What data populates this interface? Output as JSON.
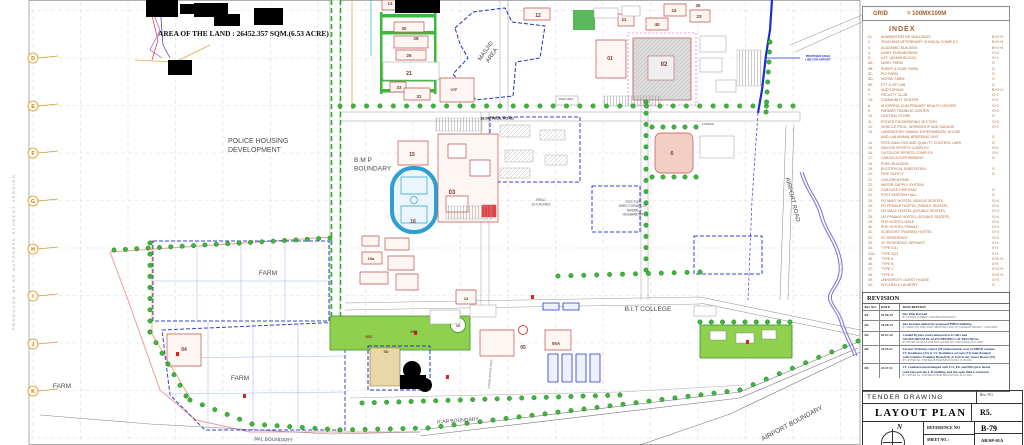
{
  "sheet": {
    "produced_by": "PRODUCED BY AN AUTODESK STUDENT VERSION",
    "area_note": "AREA OF THE LAND : 26452.357 SQM.(6.53 ACRE)"
  },
  "grid_panel": {
    "label": "GRID",
    "value": "= 100MX100M"
  },
  "index": {
    "title": "INDEX",
    "items": [
      {
        "no": "01.",
        "name": "ADMINISTRATIVE BUILDINGS",
        "fl": "B+G+3"
      },
      {
        "no": "2.",
        "name": "TEACHING VETERINARY CLINICAL COMPLEX",
        "fl": "B+G+3"
      },
      {
        "no": "3.",
        "name": "ACADEMIC BUILDING",
        "fl": "B+G+4"
      },
      {
        "no": "4.",
        "name": "DAIRY ENGINEERING",
        "fl": "G+3"
      },
      {
        "no": "5.",
        "name": "ILFC (ADMIN BLOCK)",
        "fl": "G+1"
      },
      {
        "no": "5A.",
        "name": "DAIRY FARM",
        "fl": "G"
      },
      {
        "no": "5B.",
        "name": "SHEEP & GOAT FARM",
        "fl": "G"
      },
      {
        "no": "5C.",
        "name": "PIG FARM",
        "fl": "G"
      },
      {
        "no": "5D.",
        "name": "HORSE FARM",
        "fl": "G"
      },
      {
        "no": "5E.",
        "name": "ETT & IVF LAB",
        "fl": "G"
      },
      {
        "no": "6.",
        "name": "AUDITORIUM",
        "fl": "B+G+1"
      },
      {
        "no": "7.",
        "name": "FACULTY CLUB",
        "fl": "G+1"
      },
      {
        "no": "7A.",
        "name": "COMMUNITY CENTER",
        "fl": "G+1"
      },
      {
        "no": "8.",
        "name": "SHOPPING CUM PRIMARY HEALTH CENTER",
        "fl": "G+1"
      },
      {
        "no": "9.",
        "name": "FARMER TRAINING CENTER",
        "fl": "G+2"
      },
      {
        "no": "10.",
        "name": "CENTRAL STORE",
        "fl": "G"
      },
      {
        "no": "11.",
        "name": "ESTATE ENGINEERING SECTION",
        "fl": "G+2"
      },
      {
        "no": "12.",
        "name": "VEHICLE POOL, WORKSHOP AND GARAGE",
        "fl": "G+1"
      },
      {
        "no": "13.",
        "name": "LABORATORY ANIMAL EXPERIMENTAL HOUSE",
        "fl": ""
      },
      {
        "no": "",
        "name": "AND LAB ANIMAL BREEDING UNIT",
        "fl": "G"
      },
      {
        "no": "14.",
        "name": "FEED ANALYSIS AND QUALITY CONTROL LABS",
        "fl": "G"
      },
      {
        "no": "15.",
        "name": "INDOOR SPORTS COMPLEX",
        "fl": "G+1"
      },
      {
        "no": "16.",
        "name": "OUTDOOR SPORTS COMPLEX",
        "fl": "G+1"
      },
      {
        "no": "17.",
        "name": "CAR/SCOOTER PARKING",
        "fl": "G"
      },
      {
        "no": "18.",
        "name": "PHED BUILDING",
        "fl": ""
      },
      {
        "no": "19.",
        "name": "ELECTRICAL SUBSTATION",
        "fl": "G"
      },
      {
        "no": "20.",
        "name": "FIRE SAFETY",
        "fl": "G"
      },
      {
        "no": "21.",
        "name": "CHILDREN PARK",
        "fl": ""
      },
      {
        "no": "22.",
        "name": "WATER SUPPLY SYSTEM",
        "fl": ""
      },
      {
        "no": "23.",
        "name": "CARCASS DISPOSAL",
        "fl": "G"
      },
      {
        "no": "24.",
        "name": "POST MORTEM HALL",
        "fl": "G"
      },
      {
        "no": "25.",
        "name": "PG MALE HOSTEL (SINGLE SEATER)",
        "fl": "G+4"
      },
      {
        "no": "26.",
        "name": "PG FEMALE HOSTEL (SINGLE SEATER)",
        "fl": "G+4"
      },
      {
        "no": "27.",
        "name": "UG MALE HOSTEL (DOUBLE SEATER)",
        "fl": "G+4"
      },
      {
        "no": "28.",
        "name": "UG FEMALE HOSTEL (DOUBLE SEATER)",
        "fl": "G+4"
      },
      {
        "no": "29.",
        "name": "PHD HOSTEL MALE",
        "fl": "G+4"
      },
      {
        "no": "30.",
        "name": "PHD HOSTEL FEMALE",
        "fl": "G+4"
      },
      {
        "no": "31.",
        "name": "SCIENTIST TRAINING HOSTEL",
        "fl": "G+4"
      },
      {
        "no": "32.",
        "name": "VC RESIDENCE",
        "fl": "G+2"
      },
      {
        "no": "33.",
        "name": "VC RESIDENCE SERVANT",
        "fl": "G+1"
      },
      {
        "no": "34.",
        "name": "TYPE S(1)",
        "fl": "S+4"
      },
      {
        "no": "34A.",
        "name": "TYPE S(2)",
        "fl": "S+4"
      },
      {
        "no": "35.",
        "name": "TYPE A",
        "fl": "S+G+4"
      },
      {
        "no": "36.",
        "name": "TYPE B",
        "fl": "S+4"
      },
      {
        "no": "37.",
        "name": "TYPE C",
        "fl": "S+G+4"
      },
      {
        "no": "38.",
        "name": "TYPE E",
        "fl": "S+G+4"
      },
      {
        "no": "39.",
        "name": "UNIVERSITY GUEST HOUSE",
        "fl": "G+4"
      },
      {
        "no": "40.",
        "name": "KITCHEN & LAUNDRY",
        "fl": "G"
      }
    ]
  },
  "revision": {
    "title": "REVISION",
    "headers": {
      "no": "Rev NO.",
      "date": "DATE",
      "desc": "DESCRIPTION"
    },
    "rows": [
      {
        "no": "R1.",
        "date": "01-08-19",
        "lines": [
          "Site Plan Revised"
        ],
        "note": "BY LETTER NUMBER -1148 REGISTRAR RAU"
      },
      {
        "no": "R2.",
        "date": "18-08-19",
        "lines": [
          "Site location added for proposed PHED building"
        ],
        "note": "BY MEMO NO. 1849 JOINT ARCHITECT BCD (P) SUNEESH RAPERT - 4 RAU/BCD"
      },
      {
        "no": "R3.",
        "date": "02-07-20",
        "lines": [
          "Candid Bypass road connected to ICAR road",
          "AUDITORIUM PLACED BEHIND L.B. BUILDING."
        ],
        "note": "BY NOTED ON 06-07-2020 AND LETTER NO. 2139 DATED 29-07-2020"
      },
      {
        "no": "R4.",
        "date": "24-05-21",
        "lines": [
          "Farmer Training Centre (09) Relocated in west of PHED campus",
          "VC Residence (32) & VC Residence servant (33) interchanged",
          "with Scientist Training Hostel(31) & University Guest House (39)"
        ],
        "note": "BY LETTER No. 1766 REGISTRAR BASU DATED 17-05-2021"
      },
      {
        "no": "R5.",
        "date": "23-07-21",
        "lines": [
          "VC residence interchanged with UG, PG and PhD girls hostel",
          "road between the L.B building and the open field is removed"
        ],
        "note": "BY LETTER No. 1766 REGISTRAR BASU DATED 19-07-2021"
      }
    ]
  },
  "titleblock": {
    "tender": "TENDER DRAWING",
    "rev_label": "Rev. NO.",
    "title": "LAYOUT PLAN",
    "rev": "R5.",
    "north": "N",
    "reference_label": "REFERENCE NO",
    "reference": "B-79",
    "sheet_label": "SHEET NO. :",
    "sheet": "AR/SP-01A"
  },
  "map": {
    "row_labels": [
      "D",
      "E",
      "F",
      "G",
      "H",
      "I",
      "J",
      "K"
    ],
    "labels": [
      {
        "lines": [
          "AREA OF THE LAND : 26452.357 SQM.(6.53 ACRE)"
        ],
        "x": 158,
        "y": 36,
        "s": 7.4,
        "cls": "serifb",
        "a": "s"
      },
      {
        "lines": [
          "POLICE HOUSING",
          "DEVELOPMENT"
        ],
        "x": 228,
        "y": 143,
        "s": 7,
        "a": "s",
        "cls": "grey"
      },
      {
        "lines": [
          "B.M P",
          "BOUNDARY"
        ],
        "x": 354,
        "y": 162,
        "s": 6.6,
        "a": "s",
        "cls": "grey"
      },
      {
        "lines": [
          "FARM"
        ],
        "x": 268,
        "y": 275,
        "s": 6.6,
        "a": "m",
        "cls": "grey"
      },
      {
        "lines": [
          "FARM"
        ],
        "x": 240,
        "y": 380,
        "s": 6.6,
        "a": "m",
        "cls": "grey"
      },
      {
        "lines": [
          "FARM"
        ],
        "x": 62,
        "y": 388,
        "s": 6.6,
        "a": "m",
        "cls": "grey"
      },
      {
        "lines": [
          "B.I.T COLLEGE"
        ],
        "x": 648,
        "y": 311,
        "s": 6.6,
        "a": "m",
        "cls": "grey"
      },
      {
        "lines": [
          "FIELD",
          "10.0 ACRES"
        ],
        "x": 541,
        "y": 201,
        "s": 3.4,
        "a": "m",
        "cls": "grey"
      },
      {
        "lines": [
          "SITE FOR",
          "DIRECTORATE OF",
          "ANIMAL",
          "HUSBANDRY"
        ],
        "x": 633,
        "y": 203,
        "s": 3.3,
        "a": "m",
        "cls": "grey"
      },
      {
        "lines": [
          "18.0M WIDE ROAD"
        ],
        "x": 497,
        "y": 119.5,
        "s": 3.8,
        "a": "m",
        "cls": "dark"
      },
      {
        "lines": [
          "MASJID",
          "AREA"
        ],
        "x": 487,
        "y": 52,
        "s": 6,
        "rot": -55,
        "a": "m",
        "cls": "grey"
      },
      {
        "lines": [
          "AIRPORT ROAD"
        ],
        "x": 791,
        "y": 200,
        "s": 6,
        "rot": 76,
        "a": "m",
        "cls": "grey"
      },
      {
        "lines": [
          "AIRPORT BOUNDARY"
        ],
        "x": 793,
        "y": 425,
        "s": 6.6,
        "rot": -28,
        "a": "m",
        "cls": "grey"
      },
      {
        "lines": [
          "ICAR BOUNDARY"
        ],
        "x": 458,
        "y": 422,
        "s": 5,
        "rot": -4,
        "a": "m",
        "cls": "grey"
      },
      {
        "lines": [
          "JAIL BOUNDARY"
        ],
        "x": 273,
        "y": 441,
        "s": 5,
        "rot": 2,
        "a": "m",
        "cls": "grey"
      },
      {
        "lines": [
          "PROPOSED 33KVA",
          "LINE FOR AIRPORT"
        ],
        "x": 818,
        "y": 57,
        "s": 2.7,
        "a": "m",
        "cls": "blue"
      },
      {
        "lines": [
          "COMFED"
        ],
        "x": 708,
        "y": 125,
        "s": 2.8,
        "a": "m",
        "cls": "grey"
      },
      {
        "lines": [
          "PARK AREA"
        ],
        "x": 566,
        "y": 100,
        "s": 2.6,
        "a": "m",
        "cls": "grey"
      },
      {
        "lines": [
          "CANDID BYPASS ROAD"
        ],
        "x": 491,
        "y": 374,
        "s": 2.6,
        "rot": -85,
        "a": "m",
        "cls": "grey"
      }
    ],
    "building_numbers": [
      {
        "t": "01",
        "x": 610,
        "y": 60,
        "s": 5
      },
      {
        "t": "02",
        "x": 664,
        "y": 66,
        "s": 6
      },
      {
        "t": "03",
        "x": 452,
        "y": 194,
        "s": 6
      },
      {
        "t": "04",
        "x": 184,
        "y": 351,
        "s": 5
      },
      {
        "t": "05",
        "x": 523,
        "y": 349,
        "s": 5
      },
      {
        "t": "05A",
        "x": 556,
        "y": 345,
        "s": 4.5
      },
      {
        "t": "05B",
        "x": 414,
        "y": 333,
        "s": 4
      },
      {
        "t": "05C",
        "x": 369,
        "y": 338,
        "s": 4
      },
      {
        "t": "10",
        "x": 458,
        "y": 327,
        "s": 4
      },
      {
        "t": "12",
        "x": 538,
        "y": 17,
        "s": 5
      },
      {
        "t": "13",
        "x": 466,
        "y": 300,
        "s": 4
      },
      {
        "t": "14",
        "x": 390,
        "y": 5,
        "s": 4.5
      },
      {
        "t": "15",
        "x": 412,
        "y": 156,
        "s": 5
      },
      {
        "t": "16",
        "x": 413,
        "y": 223,
        "s": 5
      },
      {
        "t": "19a",
        "x": 371,
        "y": 260,
        "s": 4
      },
      {
        "t": "21",
        "x": 409,
        "y": 75,
        "s": 5.5
      },
      {
        "t": "23",
        "x": 699,
        "y": 18,
        "s": 4.5
      },
      {
        "t": "24",
        "x": 674,
        "y": 12,
        "s": 4.5
      },
      {
        "t": "26",
        "x": 409,
        "y": 57,
        "s": 4.5
      },
      {
        "t": "26",
        "x": 698,
        "y": 7,
        "s": 4.5
      },
      {
        "t": "28",
        "x": 416,
        "y": 40,
        "s": 4.5
      },
      {
        "t": "30",
        "x": 404,
        "y": 30,
        "s": 4.5
      },
      {
        "t": "32",
        "x": 419,
        "y": 98,
        "s": 4.5
      },
      {
        "t": "33",
        "x": 399,
        "y": 89,
        "s": 4.5
      },
      {
        "t": "40",
        "x": 657,
        "y": 26,
        "s": 4.5
      },
      {
        "t": "11",
        "x": 624,
        "y": 21,
        "s": 4.5
      },
      {
        "t": "07F",
        "x": 454,
        "y": 91,
        "s": 4
      },
      {
        "t": "6",
        "x": 672,
        "y": 155,
        "s": 5.5
      },
      {
        "t": "5D",
        "x": 386,
        "y": 353,
        "s": 4
      }
    ]
  }
}
